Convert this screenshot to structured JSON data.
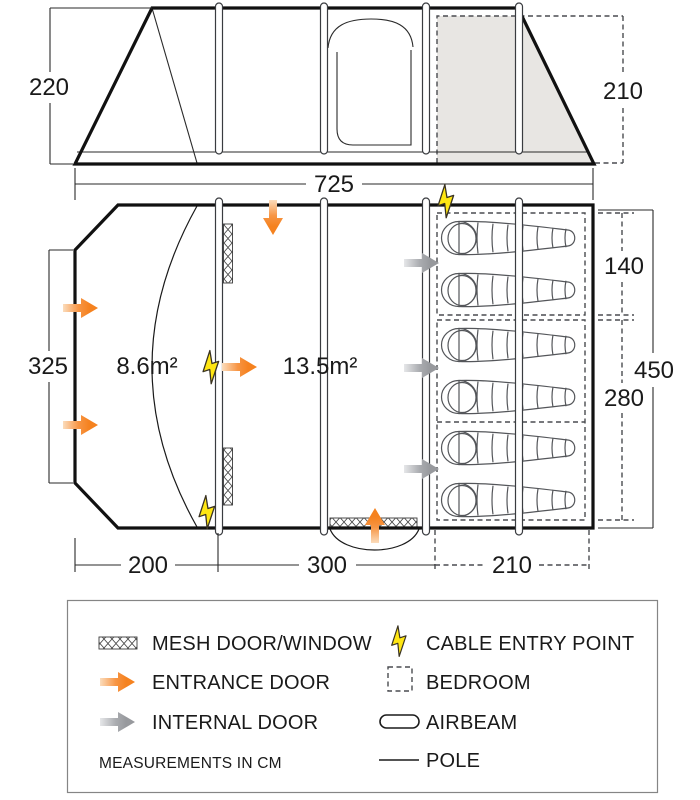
{
  "elevation": {
    "left_height": "220",
    "right_height": "210",
    "total_width": "725"
  },
  "floorplan": {
    "left_depth": "325",
    "porch_area": "8.6m²",
    "living_area": "13.5m²",
    "bedroom_front_depth": "140",
    "bedroom_rear_depth": "280",
    "bedroom_total_depth": "450",
    "porch_length": "200",
    "living_length": "300",
    "bedroom_length": "210"
  },
  "legend": {
    "mesh_label": "MESH DOOR/WINDOW",
    "entrance_label": "ENTRANCE DOOR",
    "internal_label": "INTERNAL DOOR",
    "note": "MEASUREMENTS IN CM",
    "cable_label": "CABLE ENTRY POINT",
    "bedroom_label": "BEDROOM",
    "airbeam_label": "AIRBEAM",
    "pole_label": "POLE"
  },
  "colors": {
    "accent_orange": "#f5821f",
    "internal_gray": "#97999d",
    "bolt_yellow": "#ffe612",
    "bedroom_fill": "#e8e6e3",
    "outline": "#1a1a1a"
  }
}
